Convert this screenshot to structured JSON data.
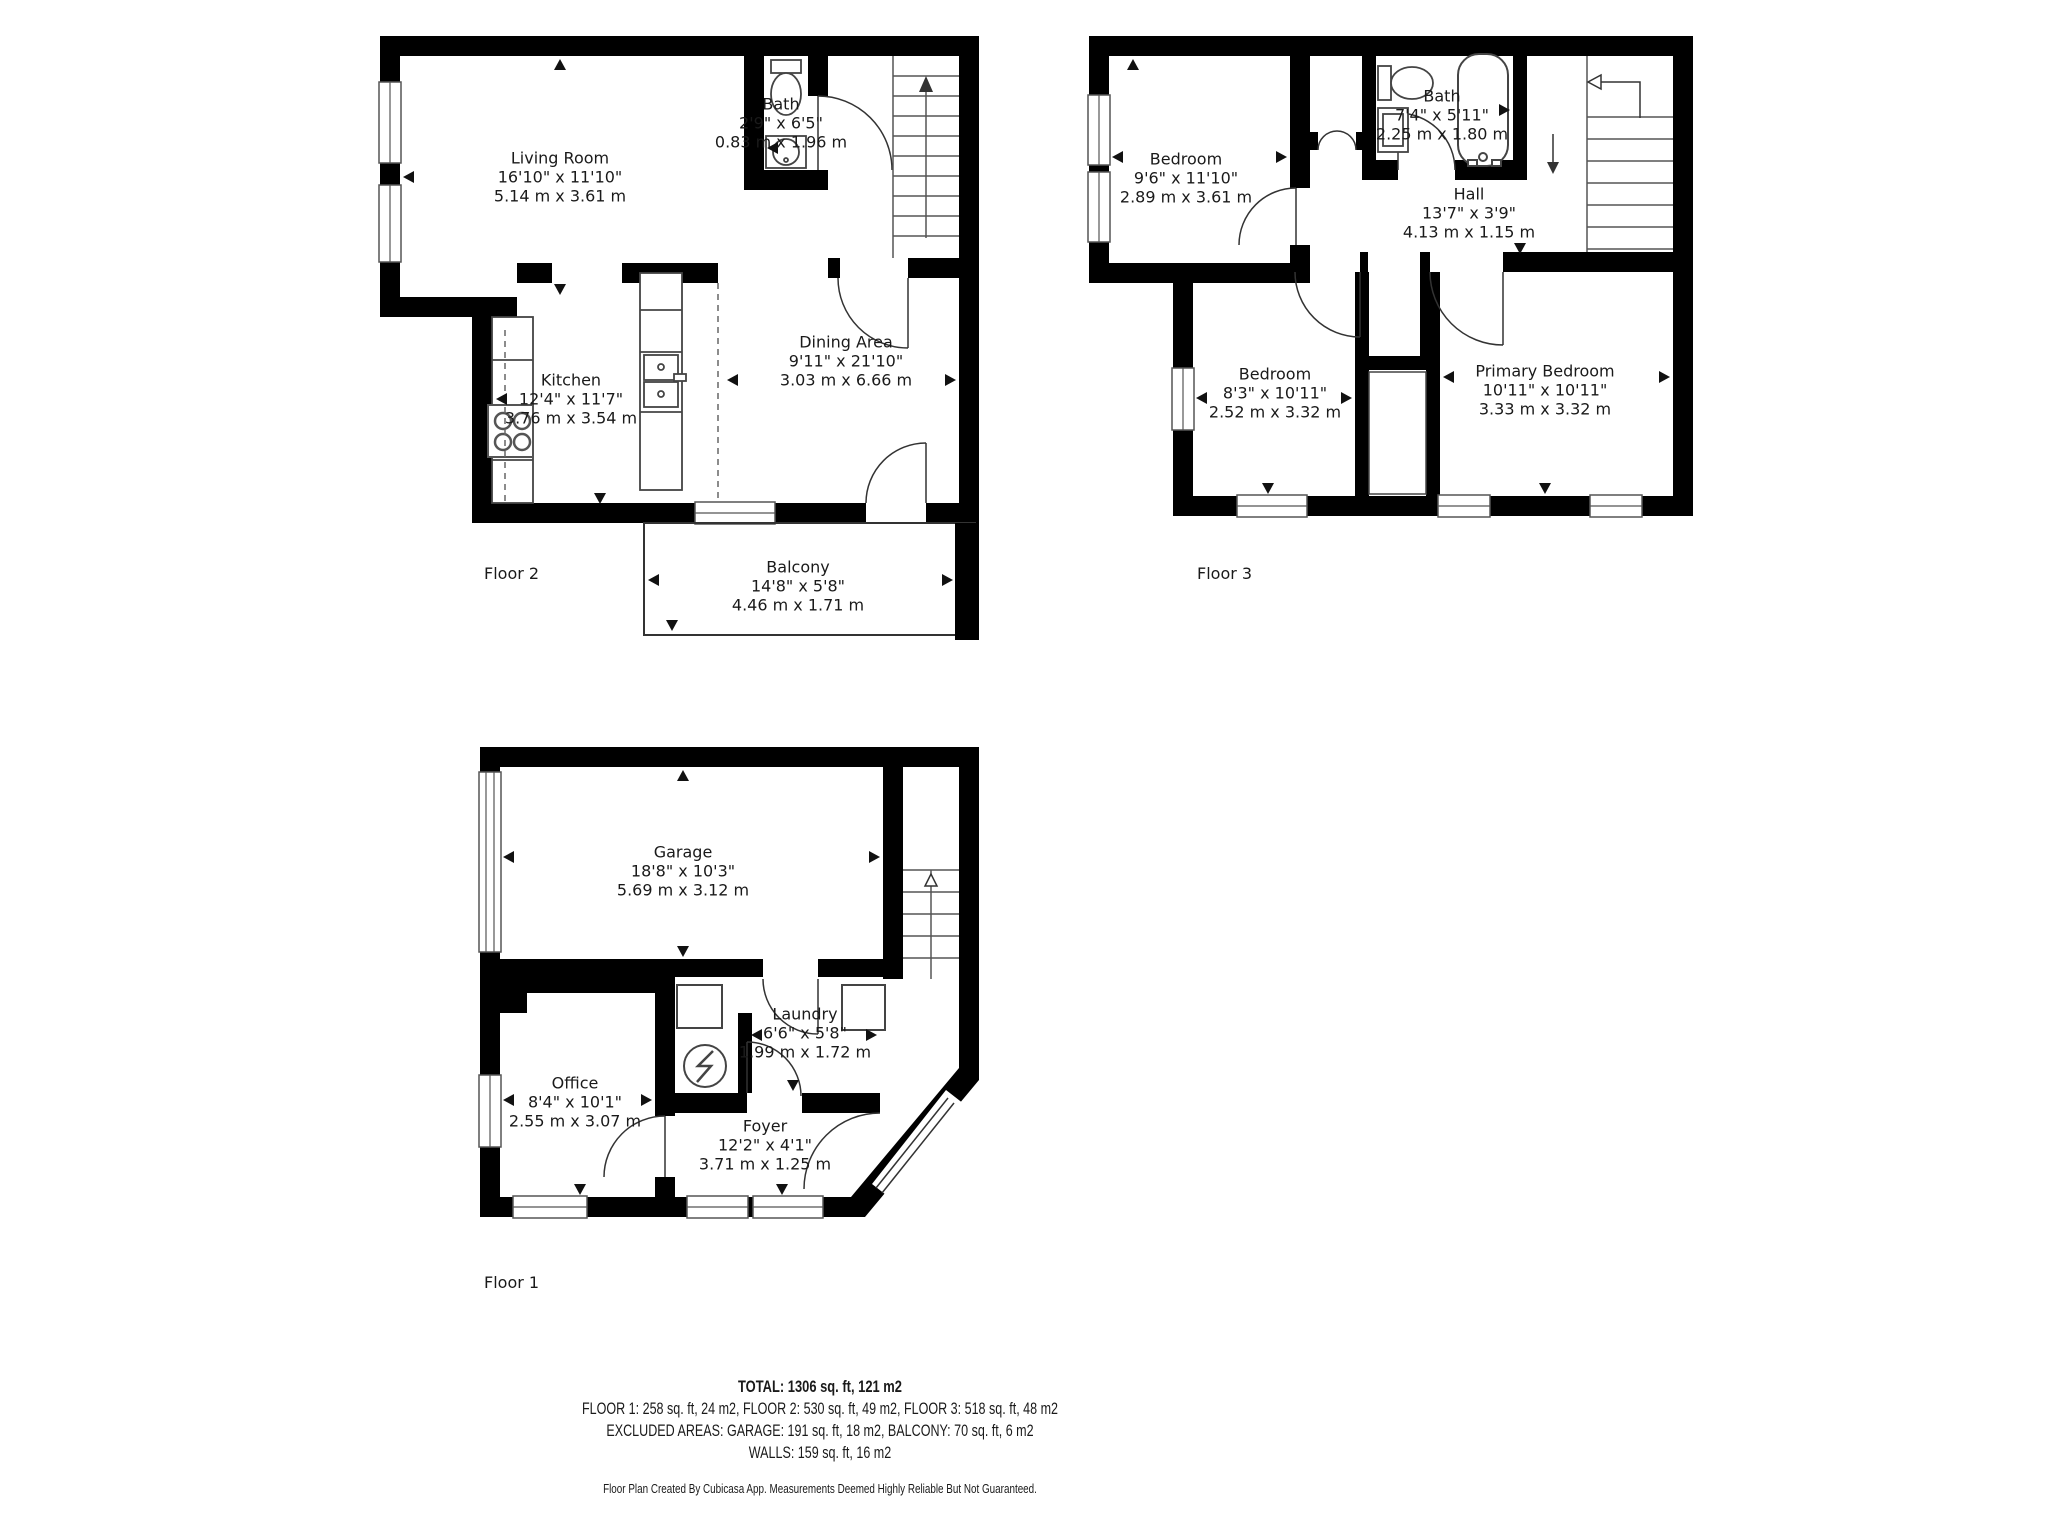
{
  "floors": [
    {
      "label": "Floor 2",
      "rooms": [
        {
          "name": "Living Room",
          "imperial": "16'10\" x 11'10\"",
          "metric": "5.14 m x 3.61 m"
        },
        {
          "name": "Bath",
          "imperial": "2'9\" x 6'5\"",
          "metric": "0.83 m x 1.96 m"
        },
        {
          "name": "Kitchen",
          "imperial": "12'4\" x 11'7\"",
          "metric": "3.76 m x 3.54 m"
        },
        {
          "name": "Dining Area",
          "imperial": "9'11\" x 21'10\"",
          "metric": "3.03 m x 6.66 m"
        },
        {
          "name": "Balcony",
          "imperial": "14'8\" x 5'8\"",
          "metric": "4.46 m x 1.71 m"
        }
      ]
    },
    {
      "label": "Floor 3",
      "rooms": [
        {
          "name": "Bedroom",
          "imperial": "9'6\" x 11'10\"",
          "metric": "2.89 m x 3.61 m"
        },
        {
          "name": "Bath",
          "imperial": "7'4\" x 5'11\"",
          "metric": "2.25 m x 1.80 m"
        },
        {
          "name": "Hall",
          "imperial": "13'7\" x 3'9\"",
          "metric": "4.13 m x 1.15 m"
        },
        {
          "name": "Bedroom",
          "imperial": "8'3\" x 10'11\"",
          "metric": "2.52 m x 3.32 m"
        },
        {
          "name": "Primary Bedroom",
          "imperial": "10'11\" x 10'11\"",
          "metric": "3.33 m x 3.32 m"
        }
      ]
    },
    {
      "label": "Floor 1",
      "rooms": [
        {
          "name": "Garage",
          "imperial": "18'8\" x 10'3\"",
          "metric": "5.69 m x 3.12 m"
        },
        {
          "name": "Office",
          "imperial": "8'4\" x 10'1\"",
          "metric": "2.55 m x 3.07 m"
        },
        {
          "name": "Laundry",
          "imperial": "6'6\" x 5'8\"",
          "metric": "1.99 m x 1.72 m"
        },
        {
          "name": "Foyer",
          "imperial": "12'2\" x 4'1\"",
          "metric": "3.71 m x 1.25 m"
        }
      ]
    }
  ],
  "summary": {
    "total": "TOTAL: 1306 sq. ft, 121 m2",
    "floors_line": "FLOOR 1: 258 sq. ft, 24 m2, FLOOR 2: 530 sq. ft, 49 m2, FLOOR 3: 518 sq. ft, 48 m2",
    "excluded_line": "EXCLUDED AREAS: GARAGE: 191 sq. ft, 18 m2, BALCONY: 70 sq. ft, 6 m2",
    "walls_line": "WALLS: 159 sq. ft, 16 m2",
    "disclaimer": "Floor Plan Created By Cubicasa App. Measurements Deemed Highly Reliable But Not Guaranteed."
  },
  "colors": {
    "wall": "#000000",
    "text": "#1a1a1a",
    "background": "#ffffff"
  }
}
